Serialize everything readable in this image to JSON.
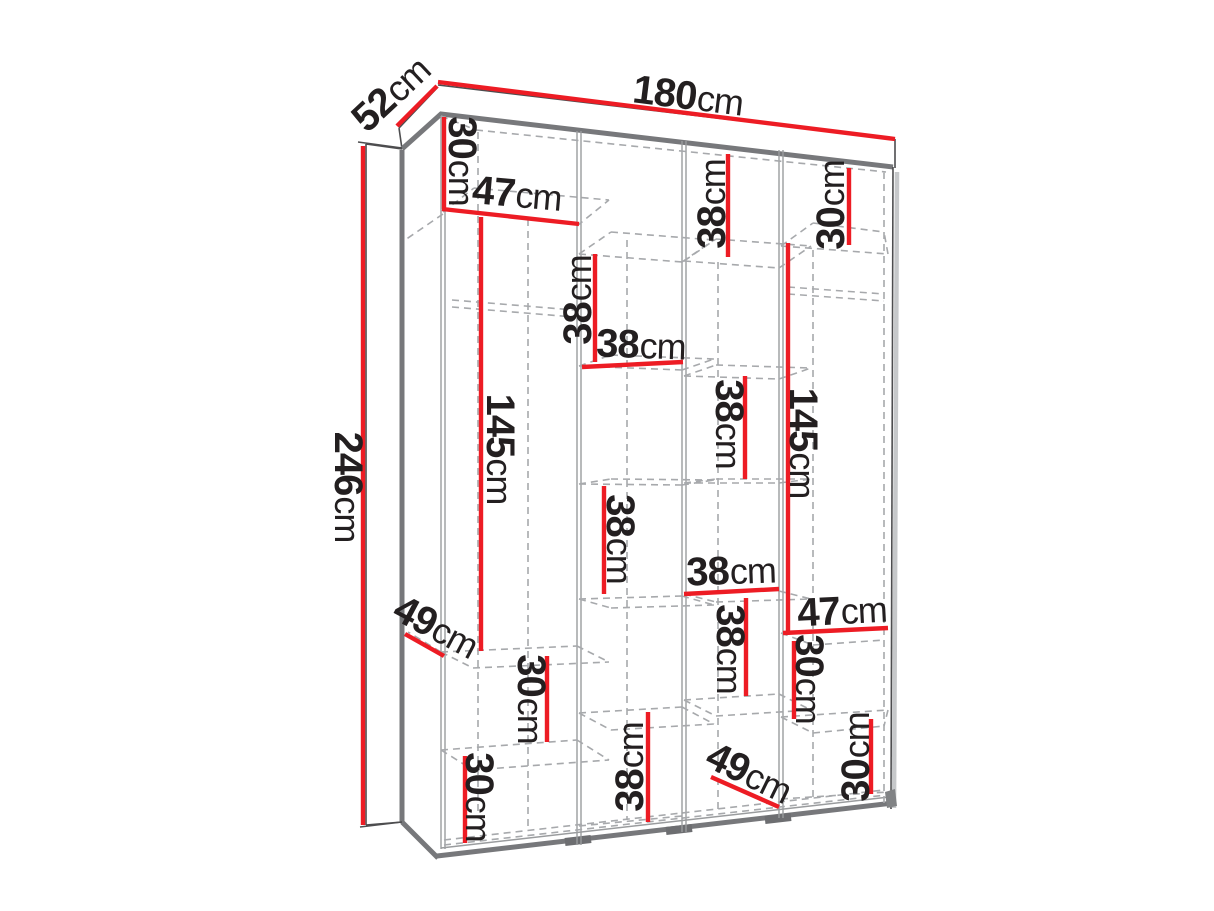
{
  "diagram": {
    "subject": "wardrobe-dimension-diagram",
    "unit": "cm",
    "overall": {
      "width": "180",
      "height": "246",
      "depth": "52"
    },
    "colors": {
      "dimension": "#ed1c24",
      "text": "#231f20",
      "edge": "#77787b",
      "dashed": "#a7a9ac"
    },
    "dimensions": [
      {
        "name": "depth-top-52",
        "value": "52",
        "unit": "cm",
        "line": {
          "x1": 397,
          "y1": 126,
          "x2": 437,
          "y2": 86
        },
        "label": {
          "x": 391,
          "y": 94,
          "rot": -43
        }
      },
      {
        "name": "width-top-180",
        "value": "180",
        "unit": "cm",
        "line": {
          "x1": 438,
          "y1": 82,
          "x2": 895,
          "y2": 139
        },
        "label": {
          "x": 688,
          "y": 96,
          "rot": 7
        }
      },
      {
        "name": "height-left-246",
        "value": "246",
        "unit": "cm",
        "line": {
          "x1": 363,
          "y1": 146,
          "x2": 363,
          "y2": 825
        },
        "label": {
          "x": 348,
          "y": 487,
          "rot": 90
        }
      },
      {
        "name": "col1-top-30",
        "value": "30",
        "unit": "cm",
        "line": {
          "x1": 444,
          "y1": 117,
          "x2": 444,
          "y2": 209
        },
        "label": {
          "x": 462,
          "y": 161,
          "rot": 90
        }
      },
      {
        "name": "col1-width-47",
        "value": "47",
        "unit": "cm",
        "line": {
          "x1": 442,
          "y1": 209,
          "x2": 579,
          "y2": 224
        },
        "label": {
          "x": 517,
          "y": 194,
          "rot": 5
        }
      },
      {
        "name": "col1-height-145",
        "value": "145",
        "unit": "cm",
        "line": {
          "x1": 481,
          "y1": 217,
          "x2": 481,
          "y2": 651
        },
        "label": {
          "x": 500,
          "y": 449,
          "rot": 90
        }
      },
      {
        "name": "col2-upper-38",
        "value": "38",
        "unit": "cm",
        "line": {
          "x1": 595,
          "y1": 254,
          "x2": 595,
          "y2": 362
        },
        "label": {
          "x": 578,
          "y": 300,
          "rot": -90
        }
      },
      {
        "name": "col2-width-38",
        "value": "38",
        "unit": "cm",
        "line": {
          "x1": 582,
          "y1": 367,
          "x2": 683,
          "y2": 362
        },
        "label": {
          "x": 641,
          "y": 345,
          "rot": 2
        }
      },
      {
        "name": "col3-top-38",
        "value": "38",
        "unit": "cm",
        "line": {
          "x1": 728,
          "y1": 154,
          "x2": 728,
          "y2": 257
        },
        "label": {
          "x": 712,
          "y": 204,
          "rot": -90
        }
      },
      {
        "name": "col4-top-30",
        "value": "30",
        "unit": "cm",
        "line": {
          "x1": 849,
          "y1": 168,
          "x2": 849,
          "y2": 245
        },
        "label": {
          "x": 831,
          "y": 205,
          "rot": -90
        }
      },
      {
        "name": "col4-height-145",
        "value": "145",
        "unit": "cm",
        "line": {
          "x1": 788,
          "y1": 243,
          "x2": 788,
          "y2": 631
        },
        "label": {
          "x": 803,
          "y": 443,
          "rot": 90
        }
      },
      {
        "name": "col3-mid-38",
        "value": "38",
        "unit": "cm",
        "line": {
          "x1": 745,
          "y1": 376,
          "x2": 745,
          "y2": 479
        },
        "label": {
          "x": 729,
          "y": 424,
          "rot": 90
        }
      },
      {
        "name": "col2-mid-38",
        "value": "38",
        "unit": "cm",
        "line": {
          "x1": 604,
          "y1": 486,
          "x2": 604,
          "y2": 594
        },
        "label": {
          "x": 620,
          "y": 539,
          "rot": 90
        }
      },
      {
        "name": "col3-width-38",
        "value": "38",
        "unit": "cm",
        "line": {
          "x1": 684,
          "y1": 594,
          "x2": 779,
          "y2": 589
        },
        "label": {
          "x": 731,
          "y": 571,
          "rot": -2
        }
      },
      {
        "name": "col4-width-47",
        "value": "47",
        "unit": "cm",
        "line": {
          "x1": 783,
          "y1": 633,
          "x2": 888,
          "y2": 628
        },
        "label": {
          "x": 842,
          "y": 611,
          "rot": -3
        }
      },
      {
        "name": "col4-mid-30",
        "value": "30",
        "unit": "cm",
        "line": {
          "x1": 794,
          "y1": 641,
          "x2": 794,
          "y2": 719
        },
        "label": {
          "x": 809,
          "y": 679,
          "rot": 90
        }
      },
      {
        "name": "depth-shelf-49-upper",
        "value": "49",
        "unit": "cm",
        "line": {
          "x1": 405,
          "y1": 634,
          "x2": 444,
          "y2": 656
        },
        "label": {
          "x": 436,
          "y": 627,
          "rot": 28
        }
      },
      {
        "name": "col1-mid-30",
        "value": "30",
        "unit": "cm",
        "line": {
          "x1": 547,
          "y1": 656,
          "x2": 547,
          "y2": 742
        },
        "label": {
          "x": 531,
          "y": 699,
          "rot": 90
        }
      },
      {
        "name": "col2-bottom-38",
        "value": "38",
        "unit": "cm",
        "line": {
          "x1": 648,
          "y1": 712,
          "x2": 648,
          "y2": 822
        },
        "label": {
          "x": 630,
          "y": 767,
          "rot": -90
        }
      },
      {
        "name": "col3-bottom-38",
        "value": "38",
        "unit": "cm",
        "line": {
          "x1": 746,
          "y1": 598,
          "x2": 746,
          "y2": 696
        },
        "label": {
          "x": 730,
          "y": 649,
          "rot": 90
        }
      },
      {
        "name": "depth-shelf-49-lower",
        "value": "49",
        "unit": "cm",
        "line": {
          "x1": 711,
          "y1": 777,
          "x2": 779,
          "y2": 807
        },
        "label": {
          "x": 749,
          "y": 773,
          "rot": 26
        }
      },
      {
        "name": "col1-bottom-30",
        "value": "30",
        "unit": "cm",
        "line": {
          "x1": 465,
          "y1": 756,
          "x2": 465,
          "y2": 843
        },
        "label": {
          "x": 479,
          "y": 797,
          "rot": 90
        }
      },
      {
        "name": "col4-bottom-30",
        "value": "30",
        "unit": "cm",
        "line": {
          "x1": 871,
          "y1": 719,
          "x2": 871,
          "y2": 794
        },
        "label": {
          "x": 856,
          "y": 757,
          "rot": -90
        }
      }
    ]
  }
}
